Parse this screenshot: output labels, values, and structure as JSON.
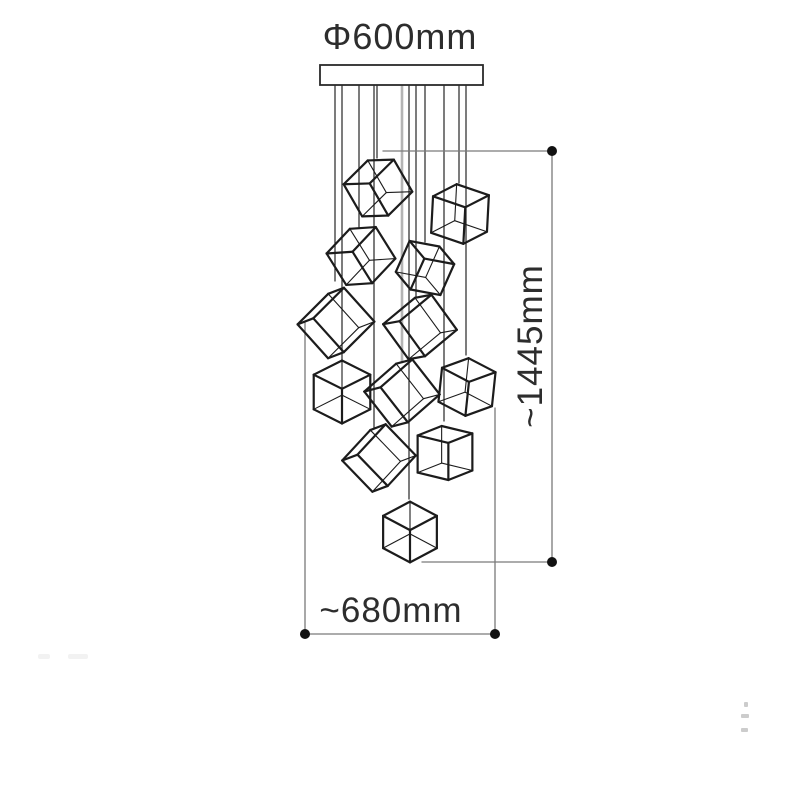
{
  "labels": {
    "diameter": "Φ600mm",
    "height": "~1445mm",
    "width": "~680mm"
  },
  "colors": {
    "ink": "#1c1c1c",
    "dim_line": "#7a7a7a",
    "dim_dot": "#111111",
    "wire": "#2e2e2e",
    "gray_wire": "#b4b4b4",
    "text": "#2d2d2d",
    "canopy_fill": "#ffffff",
    "canopy_stroke": "#2a2a2a",
    "background": "#ffffff"
  },
  "canopy": {
    "x": 320,
    "y": 65,
    "w": 163,
    "h": 20
  },
  "wires": [
    {
      "x": 335,
      "y1": 85,
      "y2": 281
    },
    {
      "x": 342,
      "y1": 85,
      "y2": 361
    },
    {
      "x": 359,
      "y1": 85,
      "y2": 227
    },
    {
      "x": 374,
      "y1": 85,
      "y2": 429
    },
    {
      "x": 377,
      "y1": 85,
      "y2": 158
    },
    {
      "x": 402,
      "y1": 85,
      "y2": 362,
      "gray": true
    },
    {
      "x": 409,
      "y1": 85,
      "y2": 499
    },
    {
      "x": 416,
      "y1": 85,
      "y2": 297
    },
    {
      "x": 425,
      "y1": 85,
      "y2": 242
    },
    {
      "x": 444,
      "y1": 85,
      "y2": 421
    },
    {
      "x": 459,
      "y1": 85,
      "y2": 183
    },
    {
      "x": 466,
      "y1": 85,
      "y2": 355
    }
  ],
  "cubes": [
    {
      "cx": 378,
      "cy": 188,
      "s": 40,
      "yaw": 35,
      "pitch": 22,
      "roll": -30
    },
    {
      "cx": 460,
      "cy": 214,
      "s": 40,
      "yaw": 55,
      "pitch": 24,
      "roll": 3
    },
    {
      "cx": 361,
      "cy": 256,
      "s": 40,
      "yaw": 35,
      "pitch": 22,
      "roll": -32
    },
    {
      "cx": 425,
      "cy": 268,
      "s": 36,
      "yaw": 35,
      "pitch": 20,
      "roll": 24
    },
    {
      "cx": 336,
      "cy": 323,
      "s": 46,
      "yaw": 20,
      "pitch": 8,
      "roll": -42
    },
    {
      "cx": 420,
      "cy": 327,
      "s": 44,
      "yaw": 20,
      "pitch": 10,
      "roll": -36
    },
    {
      "cx": 342,
      "cy": 392,
      "s": 40,
      "yaw": 45,
      "pitch": 30,
      "roll": 0
    },
    {
      "cx": 402,
      "cy": 393,
      "s": 45,
      "yaw": 20,
      "pitch": 9,
      "roll": -38
    },
    {
      "cx": 467,
      "cy": 387,
      "s": 38,
      "yaw": 48,
      "pitch": 26,
      "roll": 6
    },
    {
      "cx": 379,
      "cy": 458,
      "s": 44,
      "yaw": 20,
      "pitch": 9,
      "roll": -44
    },
    {
      "cx": 445,
      "cy": 453,
      "s": 39,
      "yaw": 52,
      "pitch": 18,
      "roll": 0
    },
    {
      "cx": 410,
      "cy": 532,
      "s": 38,
      "yaw": 45,
      "pitch": 32,
      "roll": 0
    }
  ],
  "height_dim": {
    "top_line": {
      "x1": 383,
      "y1": 151,
      "x2": 552,
      "y2": 151
    },
    "vertical_line": {
      "x1": 552,
      "y1": 151,
      "x2": 552,
      "y2": 562
    },
    "bottom_line": {
      "x1": 422,
      "y1": 562,
      "x2": 552,
      "y2": 562
    },
    "dots": [
      {
        "x": 552,
        "y": 151
      },
      {
        "x": 552,
        "y": 562
      }
    ]
  },
  "width_dim": {
    "left_line": {
      "x1": 305,
      "y1": 323,
      "x2": 305,
      "y2": 634
    },
    "right_line": {
      "x1": 495,
      "y1": 408,
      "x2": 495,
      "y2": 634
    },
    "bottom_line": {
      "x1": 305,
      "y1": 634,
      "x2": 495,
      "y2": 634
    },
    "dots": [
      {
        "x": 305,
        "y": 634
      },
      {
        "x": 495,
        "y": 634
      }
    ]
  }
}
